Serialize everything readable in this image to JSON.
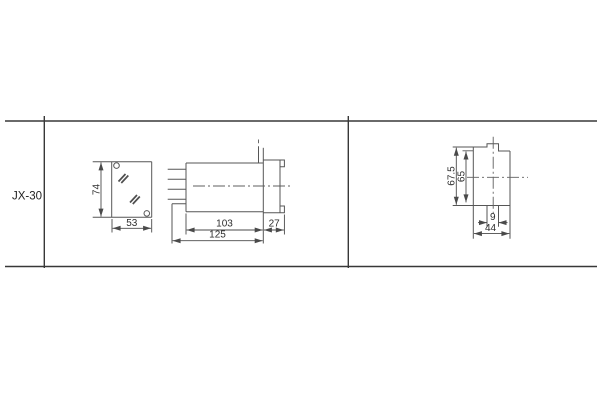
{
  "title_block": {
    "row_label": "JX-30"
  },
  "views": {
    "front": {
      "height": "74",
      "width": "53"
    },
    "side": {
      "body_length": "103",
      "flange_depth": "27",
      "total_length": "125"
    },
    "rear": {
      "outer_height": "67.5",
      "inner_height": "65",
      "tab_width": "9",
      "depth": "44"
    }
  },
  "colors": {
    "background": "#ffffff",
    "drawing_line": "#565656",
    "table_border": "#383838",
    "text": "#2e2e2e"
  }
}
